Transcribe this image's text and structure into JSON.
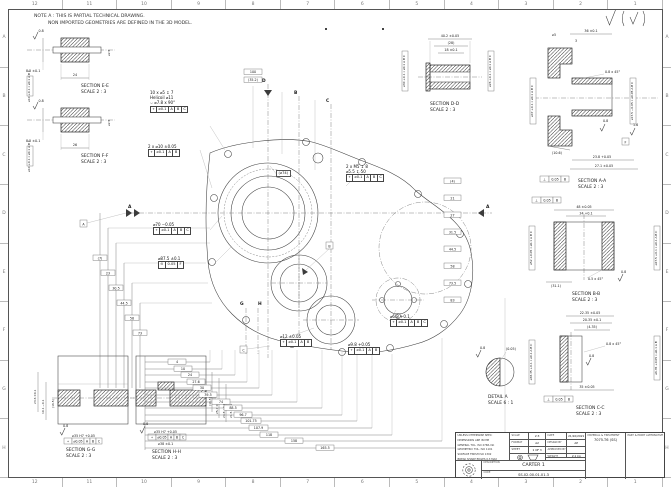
{
  "frame": {
    "cols": [
      "12",
      "11",
      "10",
      "9",
      "8",
      "7",
      "6",
      "5",
      "4",
      "3",
      "2",
      "1"
    ],
    "rows": [
      "A",
      "B",
      "C",
      "D",
      "E",
      "F",
      "G",
      "H"
    ]
  },
  "note": {
    "line1": "NOTE A : THIS IS PARTIAL TECHNICAL DRAWING.",
    "line2": "NON IMPORTED GEOMETRIES ARE DEFINED IN THE 3D MODEL."
  },
  "sections": {
    "ee": {
      "label": "SECTION E-E",
      "scale": "SCALE 2 : 3",
      "h": "8.5 ±0.1",
      "w": "24",
      "dia": "⌀2.5",
      "rough": "0.8",
      "fcf": "⌀10 +0.1  ⌖ ⌀0.1 A B C"
    },
    "ff": {
      "label": "SECTION F-F",
      "scale": "SCALE 2 : 3",
      "h": "8.5 ±0.1",
      "w": "26",
      "dia": "⌀2.5",
      "rough": "0.8",
      "fcf": "⌀10 +0.1  ⌖ ⌀0.1 A B C"
    },
    "dd": {
      "label": "SECTION D-D",
      "scale": "SCALE 2 : 3",
      "d1": "40.2 ±0.05",
      "d2": "(28)",
      "d3": "18 ±0.1",
      "fcf_left": "⌀30 +0.1  ⌖ ⌀0.1 A B C",
      "fcf_right": "⌀26 +0.1  ⌖ ⌀0.1 A B C"
    },
    "aa": {
      "label": "SECTION A-A",
      "scale": "SCALE 2 : 3",
      "d1": "36 ±0.1",
      "d2": "⌀5",
      "d3": "3",
      "d4": "0.8 x 45°",
      "d5": "(10.6)",
      "d6": "23.8 +0.05",
      "d7": "27.1 ±0.05",
      "r1": "0.8",
      "r2": "1.6",
      "fcf_left": "⌀47 +0.1  ⌖ ⌀0.1 A B C",
      "fcf_right": "⌀17.5 −0.05  ⌖ ⌀0.05 A B C",
      "fcf_bot": [
        "⟂",
        "0.05",
        "B"
      ],
      "datum": "F"
    },
    "bb": {
      "label": "SECTION B-B",
      "scale": "SCALE 2 : 3",
      "d1": "48 ±0.05",
      "d2": "34 +0.1",
      "d3": "0.5 x 45°",
      "d4": "(31.1)",
      "r1": "0.8",
      "fcf_top": [
        "⟂",
        "0.05",
        "B"
      ],
      "fcf_left": "⌀52 +0.05  ⌖ ⌀0.1 A B C",
      "fcf_right": "⌀47.5 +0.1  ⌖ ⌀0.1 A B C"
    },
    "cc": {
      "label": "SECTION C-C",
      "scale": "SCALE 2 : 3",
      "d1": "22.35 ±0.05",
      "d2": "20.35 ±0.1",
      "d3": "(4.35)",
      "d4": "0.8 x 45°",
      "d5": "35 ±0.05",
      "r1": "0.8",
      "fcf_top": [
        "⟂",
        "0.05",
        "B"
      ],
      "fcf_left": "⌀38.35 +0.1  ⌖ ⌀0.1 A B C",
      "fcf_right": "⌀6.35 +0.05  ⌖ ⌀0.1 A B"
    },
    "gg": {
      "label": "SECTION G-G",
      "scale": "SCALE 2 : 3",
      "v1": "(16.5)",
      "v2": "23.6 ±0.1",
      "v3": "10.1 −0.1",
      "rough": "0.8",
      "callout": "⌀35 H7 +0.05",
      "fcf": [
        "⌖",
        "⌀0.05",
        "A",
        "B",
        "C"
      ]
    },
    "hh": {
      "label": "SECTION H-H",
      "scale": "SCALE 2 : 3",
      "v1": "(16.5)",
      "v2": "25.7 ±0.1",
      "v3": "24.8 +0.1",
      "v4": "21.5 ±0.1",
      "rough": "0.8",
      "callout": "⌀35 H7 +0.05",
      "callout2": "⌀38 ±0.1",
      "fcf": [
        "⌖",
        "⌀0.05",
        "A",
        "B",
        "C"
      ]
    },
    "detail": {
      "label": "DETAIL A",
      "scale": "SCALE 6 : 1",
      "d1": "(0.05)",
      "rough": "0.8"
    }
  },
  "main_view": {
    "callout1": {
      "l1": "10 x ⌀5 ↧ 7",
      "l2": "Helicoil ⌀11",
      "l3": "⌵ ⌀7.8 x 90°",
      "fcf": [
        "⌖",
        "⌀0.1",
        "A",
        "B",
        "C"
      ]
    },
    "callout2": {
      "l1": "2 x ⌀10 ±0.05",
      "fcf": [
        "⌖",
        "⌀0.1",
        "A",
        "B"
      ]
    },
    "callout3": {
      "l1": "2 x M5 ↧ 8",
      "l2": "⌀5.5 ↧ 50",
      "fcf": [
        "⌖",
        "⌀0.1",
        "A",
        "B",
        "C"
      ]
    },
    "callout4": "(⌀74)",
    "callout5": {
      "l1": "⌀70 −0.05",
      "fcf": [
        "⌖",
        "⌀0.1",
        "A",
        "B",
        "C"
      ]
    },
    "callout6": {
      "l1": "⌀87.5 ±0.1",
      "fcf": [
        "⊙",
        "0.05",
        "F"
      ]
    },
    "callout7": {
      "l1": "⌀6.8 +0.1",
      "fcf": [
        "⌖",
        "⌀0.1",
        "A",
        "B",
        "C"
      ]
    },
    "callout8": {
      "l1": "⌀12 ±0.05",
      "fcf": [
        "⌖",
        "⌀0.1",
        "A",
        "B"
      ]
    },
    "callout9": {
      "l1": "⌀9.8 +0.05",
      "fcf": [
        "⌖",
        "⌀0.1",
        "A",
        "B"
      ]
    },
    "datums": {
      "a": "A",
      "b": "B",
      "c": "C"
    },
    "cuts": {
      "a": "A",
      "b": "B",
      "c": "C",
      "d": "D",
      "g": "G",
      "h": "H"
    },
    "top_dims": [
      "100",
      "(35.2)"
    ],
    "left_dims": [
      "(7)",
      "23",
      "30.5",
      "44.5",
      "58",
      "73"
    ],
    "right_dims": [
      "(4)",
      "21",
      "27",
      "31.5",
      "44.5",
      "58",
      "73.5",
      "83"
    ],
    "bottom_dims": [
      "4",
      "10",
      "24",
      "27.6",
      "30",
      "39.5",
      "74",
      "88.5",
      "96.7",
      "101.75",
      "107.9",
      "118",
      "158",
      "165.5"
    ]
  },
  "title_block": {
    "tol_lines": [
      "UNLESS OTHERWISE SPEC:",
      "DIMENSIONS ARE IN MM",
      "GENERAL TOL. ISO 2768-mK",
      "GEOMETRIC TOL. ISO 1101",
      "SURFACE FINISH ISO 1302",
      "BREAK SHARP EDGES 0.3 MAX"
    ],
    "scale": {
      "label": "SCALE",
      "value": "2:3"
    },
    "format": {
      "label": "FORMAT",
      "value": "A2"
    },
    "sheet": {
      "label": "SHEET",
      "value": "1 OF 3"
    },
    "date": {
      "label": "DATE",
      "value": "21/10/2021"
    },
    "design": {
      "label": "DESIGN BY",
      "value": "AP"
    },
    "approved": {
      "label": "APPROVED BY",
      "value": ""
    },
    "weight": {
      "label": "WEIGHT",
      "value": "2.1 kg"
    },
    "cut_asm": {
      "label": "CUT ASM"
    },
    "material": {
      "label": "MATERIAL & TREATMENT",
      "value": "7075-T6 (SS)"
    },
    "alternative": {
      "label": "PART & PRINT ALTERNATIVE",
      "value": ""
    },
    "description": {
      "label": "DESCRIPTION",
      "value": "CARTER 1"
    },
    "code": {
      "label": "CODE",
      "value": "SS.02.00.01.01.3"
    }
  }
}
